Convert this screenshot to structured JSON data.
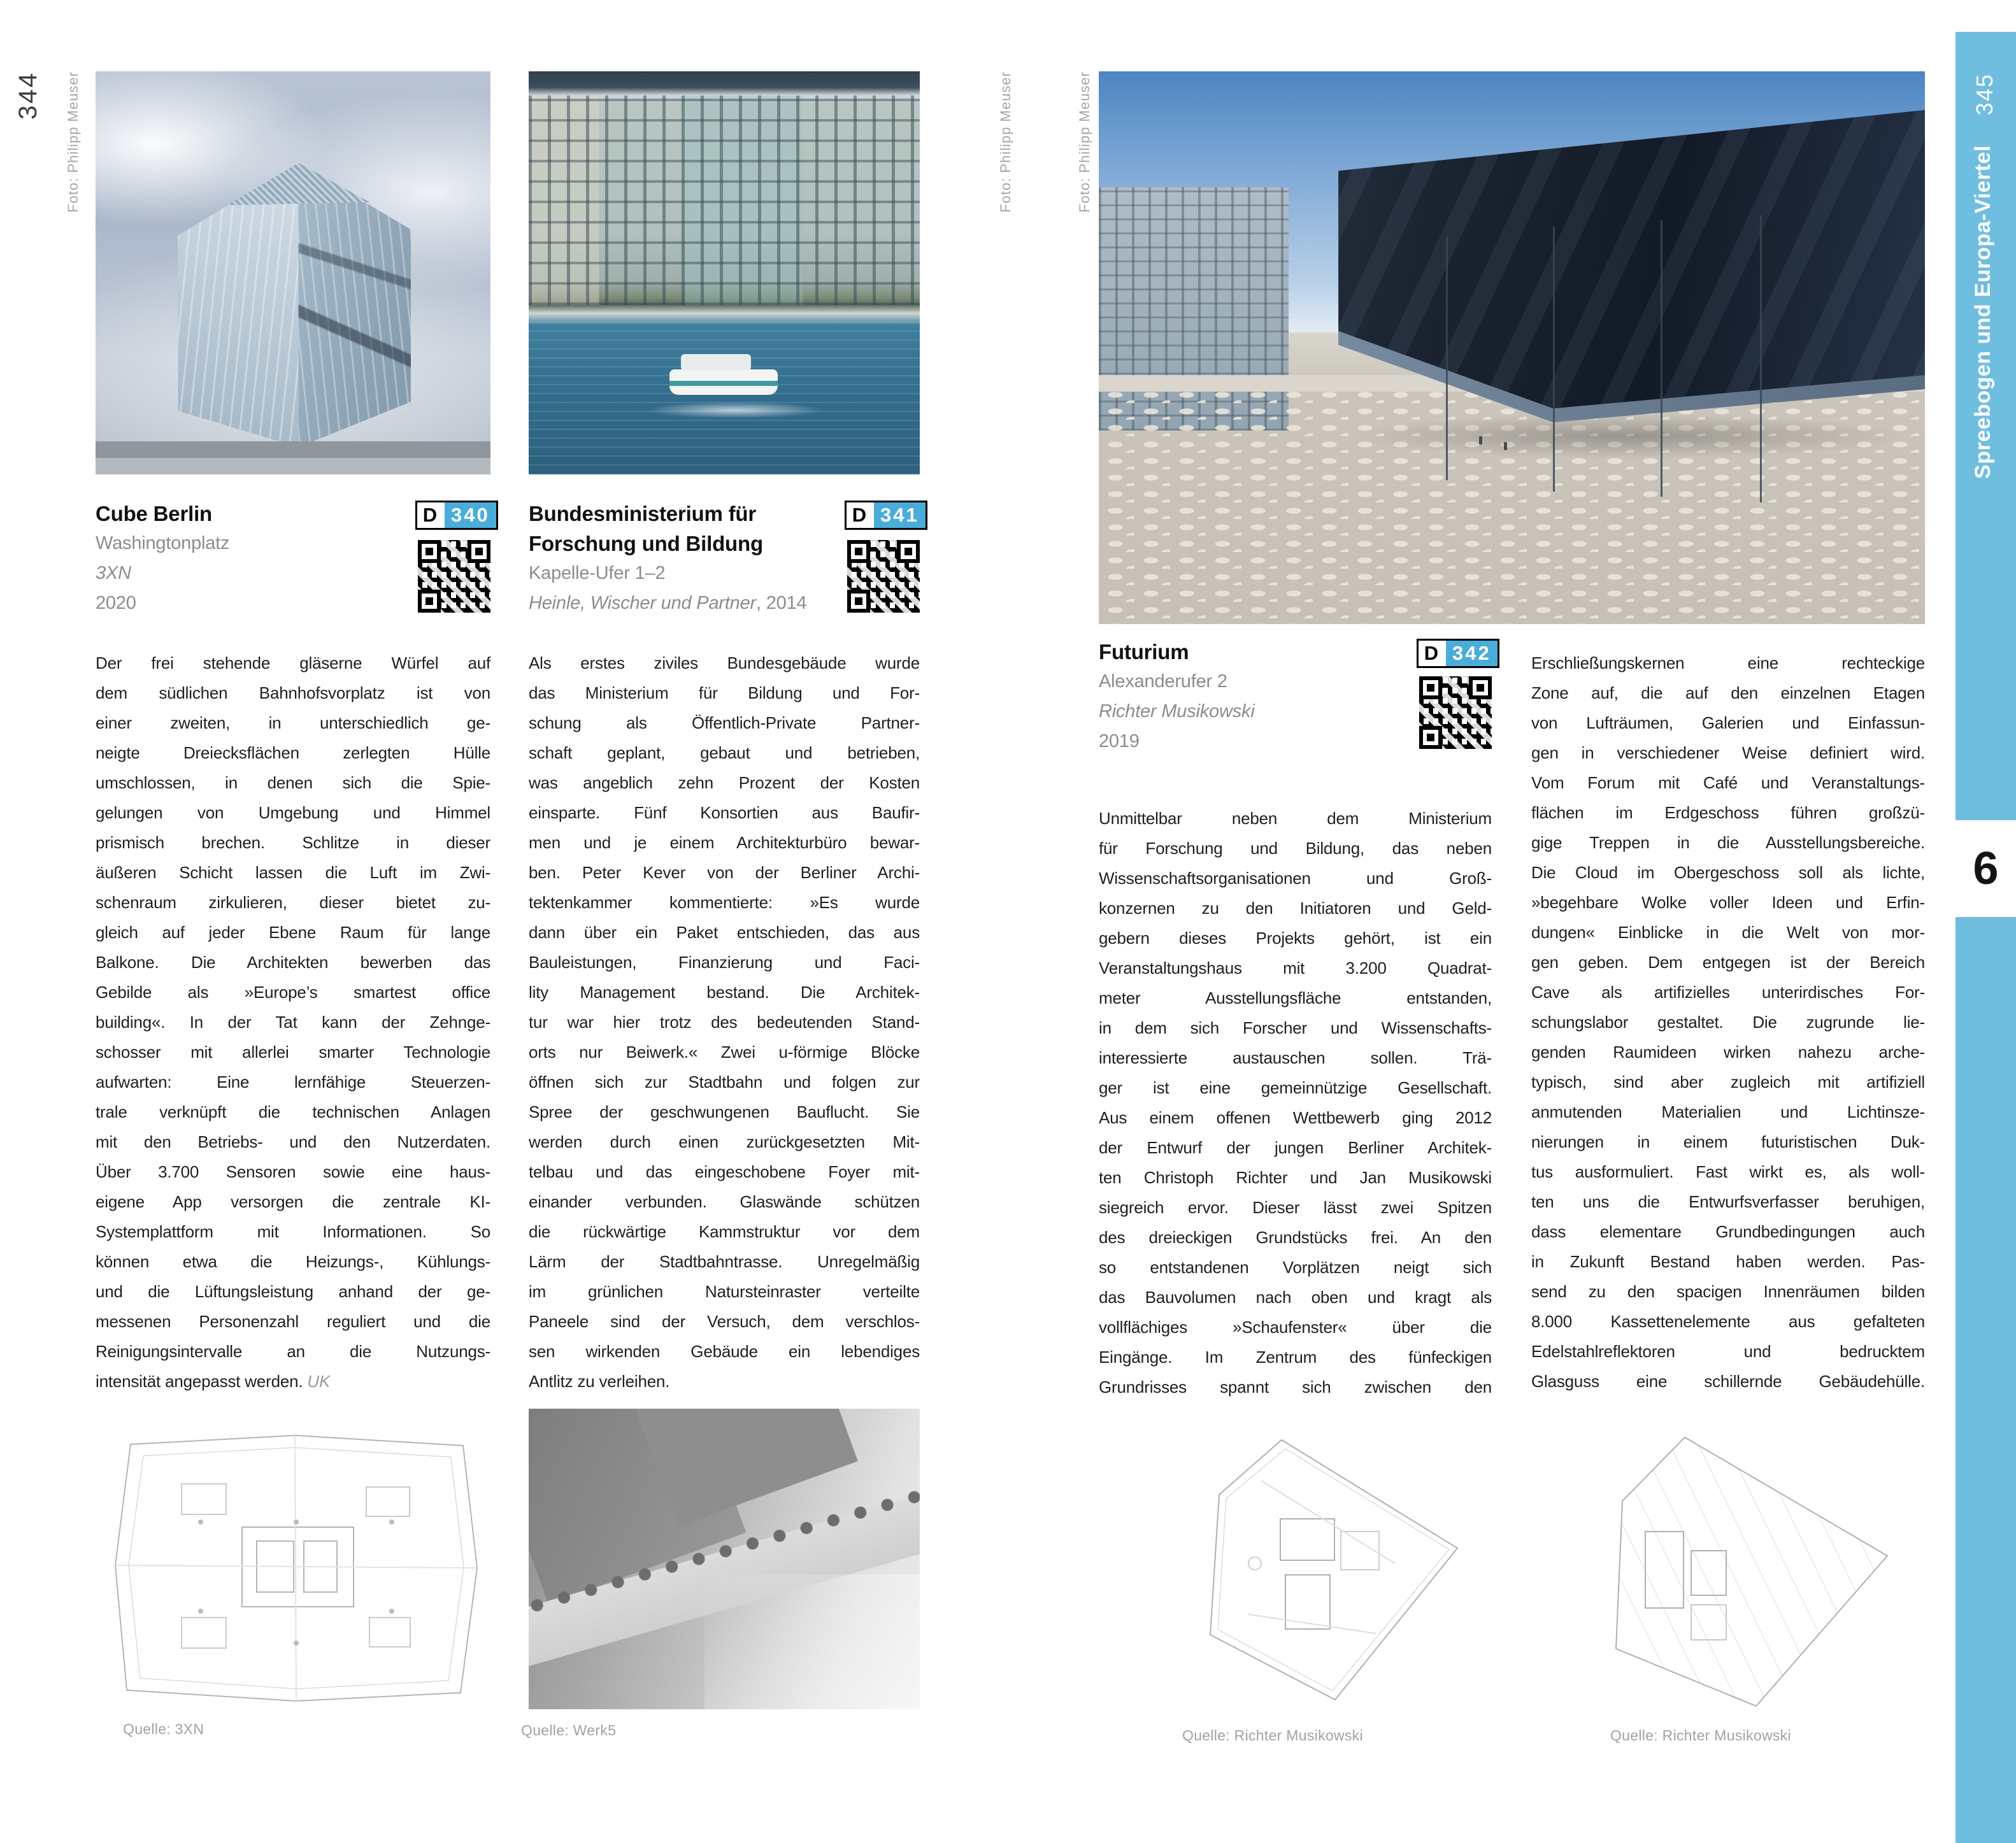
{
  "page": {
    "left_number": "344",
    "right_number": "345",
    "chapter_index": "6",
    "chapter_title": "Spreebogen und Europa-Viertel",
    "photo_credit": "Foto: Philipp Meuser",
    "sidebar_blue": "#6fbee0",
    "badge_blue": "#4aadd9"
  },
  "entries": {
    "cube": {
      "badge_letter": "D",
      "badge_number": "340",
      "title": "Cube Berlin",
      "address": "Washingtonplatz",
      "architect": "3XN",
      "year": "2020",
      "body": "Der frei stehende gläserne Würfel auf\ndem südlichen Bahnhofsvorplatz ist von\neiner zweiten, in unterschiedlich ge-\nneigte Dreiecksflächen zerlegten Hülle\numschlossen, in denen sich die Spie-\ngelungen von Umgebung und Himmel\nprismisch brechen. Schlitze in dieser\näußeren Schicht lassen die Luft im Zwi-\nschenraum zirkulieren, dieser bietet zu-\ngleich auf jeder Ebene Raum für lange\nBalkone. Die Architekten bewerben das\nGebilde als »Europe’s smartest office\nbuilding«. In der Tat kann der Zehnge-\nschosser mit allerlei smarter Technologie\naufwarten: Eine lernfähige Steuerzen-\ntrale verknüpft die technischen Anlagen\nmit den Betriebs- und den Nutzerdaten.\nÜber 3.700 Sensoren sowie eine haus-\neigene App versorgen die zentrale KI-\nSystemplattform mit Informationen. So\nkönnen etwa die Heizungs-, Kühlungs-\nund die Lüftungsleistung anhand der ge-\nmessenen Personenzahl reguliert und die\nReinigungsintervalle an die Nutzungs-",
      "body_last": "intensität angepasst werden. ",
      "initials": "UK",
      "caption": "Quelle: 3XN"
    },
    "bmbf": {
      "badge_letter": "D",
      "badge_number": "341",
      "title_line1": "Bundesministerium für",
      "title_line2": "Forschung und Bildung",
      "address": "Kapelle-Ufer 1–2",
      "architect": "Heinle, Wischer und Partner",
      "architect_suffix": ", 2014",
      "body": "Als erstes ziviles Bundesgebäude wurde\ndas Ministerium für Bildung und For-\nschung als Öffentlich-Private Partner-\nschaft geplant, gebaut und betrieben,\nwas angeblich zehn Prozent der Kosten\neinsparte. Fünf Konsortien aus Baufir-\nmen und je einem Architekturbüro bewar-\nben. Peter Kever von der Berliner Archi-\ntektenkammer kommentierte: »Es wurde\ndann über ein Paket entschieden, das aus\nBauleistungen, Finanzierung und Faci-\nlity Management bestand. Die Architek-\ntur war hier trotz des bedeutenden Stand-\norts nur Beiwerk.« Zwei u-förmige Blöcke\nöffnen sich zur Stadtbahn und folgen zur\nSpree der geschwungenen Bauflucht. Sie\nwerden durch einen zurückgesetzten Mit-\ntelbau und das eingeschobene Foyer mit-\neinander verbunden. Glaswände schützen\ndie rückwärtige Kammstruktur vor dem\nLärm der Stadtbahntrasse. Unregelmäßig\nim grünlichen Natursteinraster verteilte\nPaneele sind der Versuch, dem verschlos-\nsen wirkenden Gebäude ein lebendiges",
      "body_last": "Antlitz zu verleihen.",
      "caption": "Quelle: Werk5"
    },
    "futurium": {
      "badge_letter": "D",
      "badge_number": "342",
      "title": "Futurium",
      "address": "Alexanderufer 2",
      "architect": "Richter Musikowski",
      "year": "2019",
      "body_col1": "Unmittelbar neben dem Ministerium\nfür Forschung und Bildung, das neben\nWissenschaftsorganisationen und Groß-\nkonzernen zu den Initiatoren und Geld-\ngebern dieses Projekts gehört, ist ein\nVeranstaltungshaus mit 3.200 Quadrat-\nmeter Ausstellungsfläche entstanden,\nin dem sich Forscher und Wissenschafts-\ninteressierte austauschen sollen. Trä-\nger ist eine gemeinnützige Gesellschaft.\nAus einem offenen Wettbewerb ging 2012\nder Entwurf der jungen Berliner Architek-\nten Christoph Richter und Jan Musikowski\nsiegreich ervor. Dieser lässt zwei Spitzen\ndes dreieckigen Grundstücks frei. An den\nso entstandenen Vorplätzen neigt sich\ndas Bauvolumen nach oben und kragt als\nvollflächiges »Schaufenster« über die\nEingänge. Im Zentrum des fünfeckigen\nGrundrisses spannt sich zwischen den",
      "body_col2": "Erschließungskernen eine rechteckige\nZone auf, die auf den einzelnen Etagen\nvon Lufträumen, Galerien und Einfassun-\ngen in verschiedener Weise definiert wird.\nVom Forum mit Café und Veranstaltungs-\nflächen im Erdgeschoss führen großzü-\ngige Treppen in die Ausstellungsbereiche.\nDie Cloud im Obergeschoss soll als lichte,\n»begehbare Wolke voller Ideen und Erfin-\ndungen« Einblicke in die Welt von mor-\ngen geben. Dem entgegen ist der Bereich\nCave als artifizielles unterirdisches For-\nschungslabor gestaltet. Die zugrunde lie-\ngenden Raumideen wirken nahezu arche-\ntypisch, sind aber zugleich mit artifiziell\nanmutenden Materialien und Lichtinsze-\nnierungen in einem futuristischen Duk-\ntus ausformuliert. Fast wirkt es, als woll-\nten uns die Entwurfsverfasser beruhigen,\ndass elementare Grundbedingungen auch\nin Zukunft Bestand haben werden. Pas-\nsend zu den spacigen Innenräumen bilden\n8.000 Kassettenelemente aus gefalteten\nEdelstahlreflektoren und bedrucktem\nGlasguss eine schillernde Gebäudehülle.",
      "caption_left": "Quelle: Richter Musikowski",
      "caption_right": "Quelle: Richter Musikowski"
    }
  }
}
